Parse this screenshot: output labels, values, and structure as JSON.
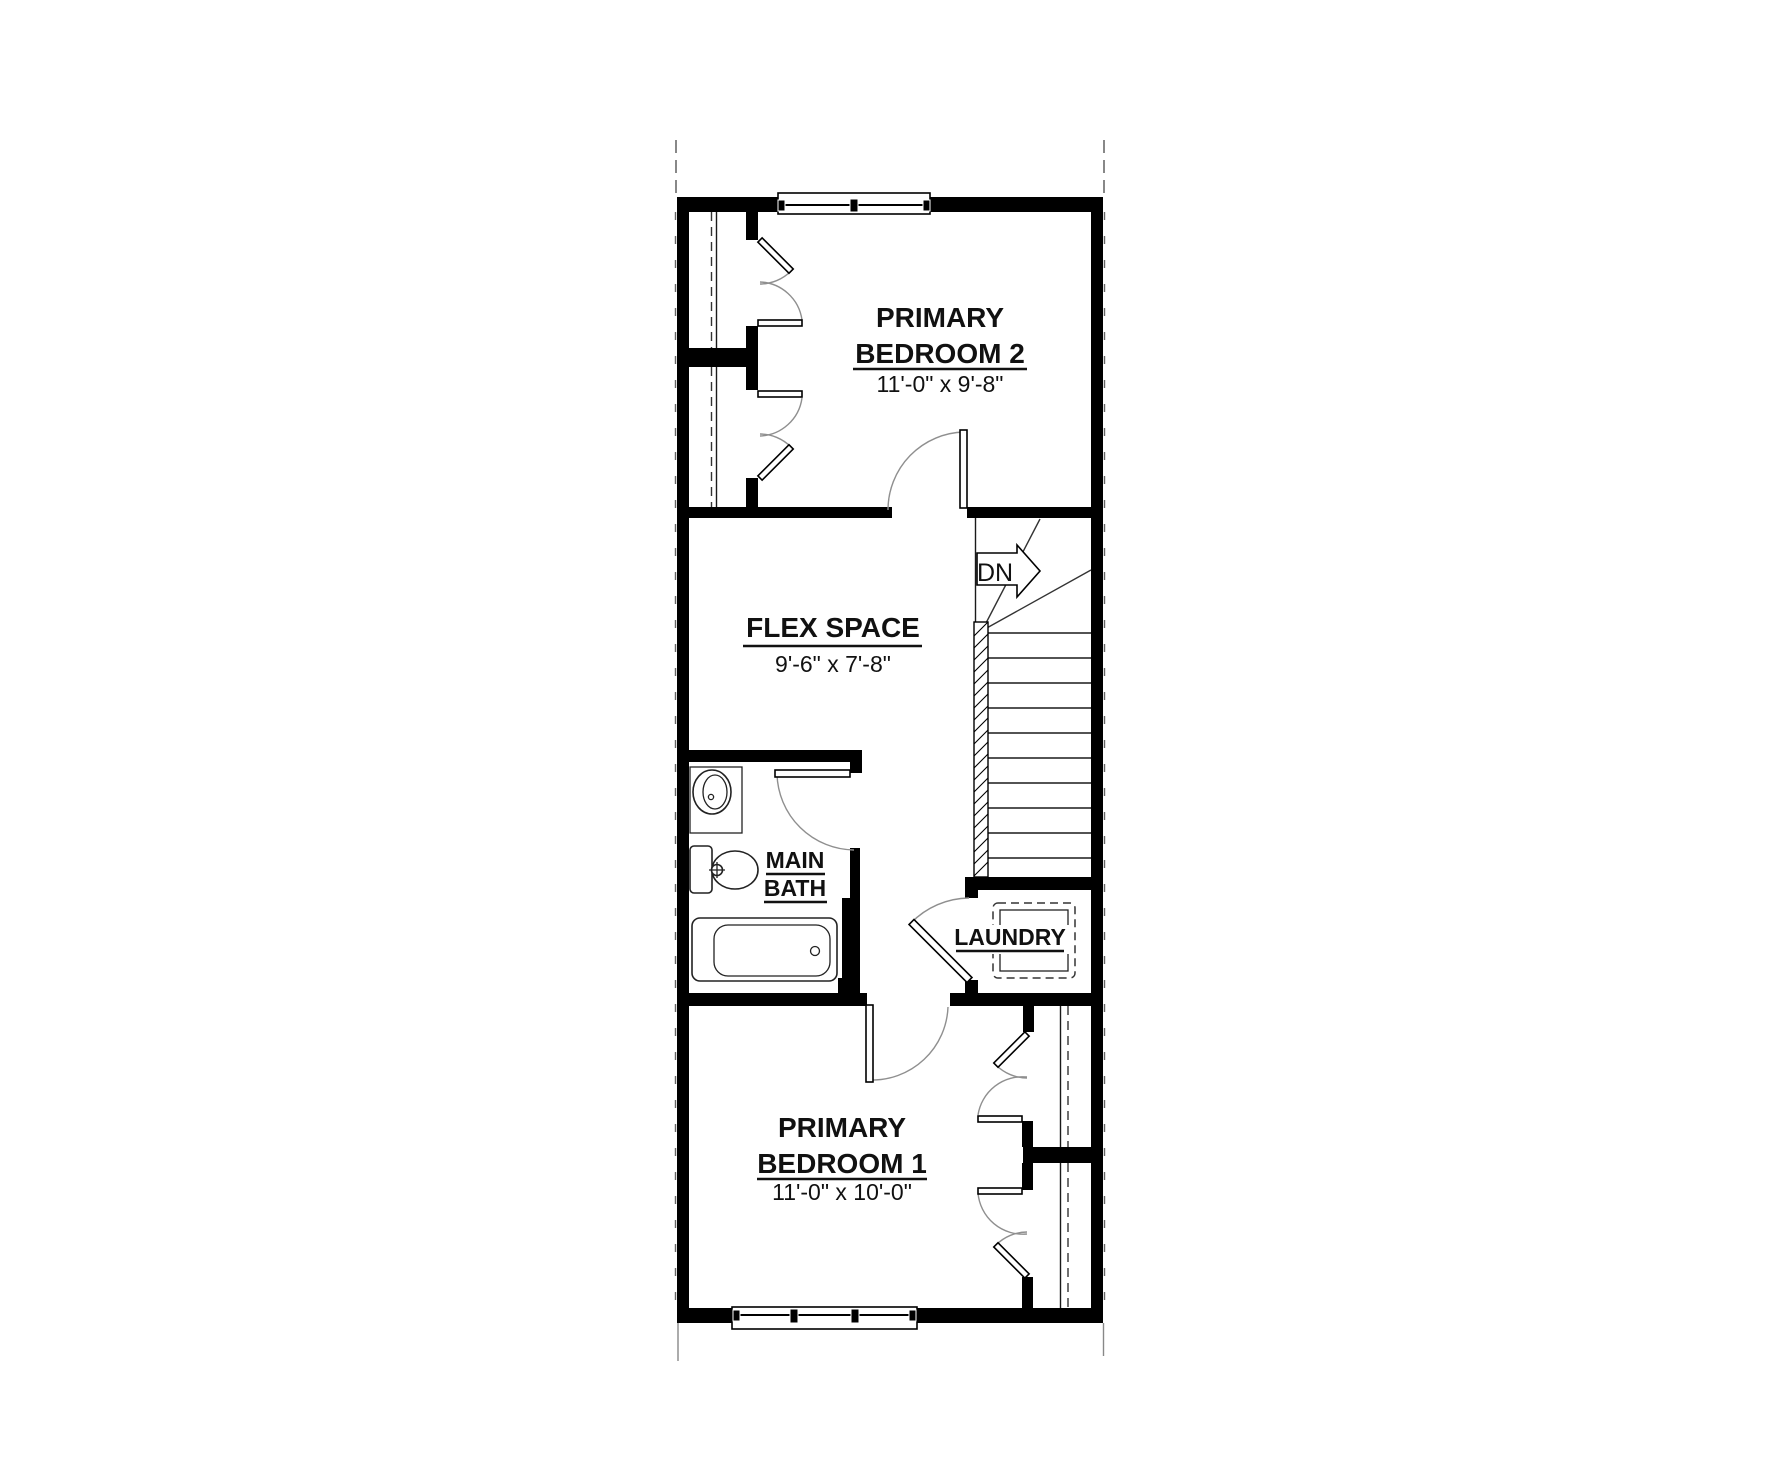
{
  "plan": {
    "rooms": {
      "primary_bedroom_2": {
        "line1": "PRIMARY",
        "line2": "BEDROOM 2",
        "dims": "11'-0\" x 9'-8\""
      },
      "flex_space": {
        "line1": "FLEX SPACE",
        "dims": "9'-6\" x 7'-8\""
      },
      "main_bath": {
        "line1": "MAIN",
        "line2": "BATH"
      },
      "laundry": {
        "line1": "LAUNDRY"
      },
      "primary_bedroom_1": {
        "line1": "PRIMARY",
        "line2": "BEDROOM 1",
        "dims": "11'-0\" x 10'-0\""
      }
    },
    "stairs": {
      "direction_label": "DN"
    },
    "colors": {
      "wall": "#000000",
      "door_swing": "#8f8f8f",
      "background": "#ffffff"
    }
  }
}
